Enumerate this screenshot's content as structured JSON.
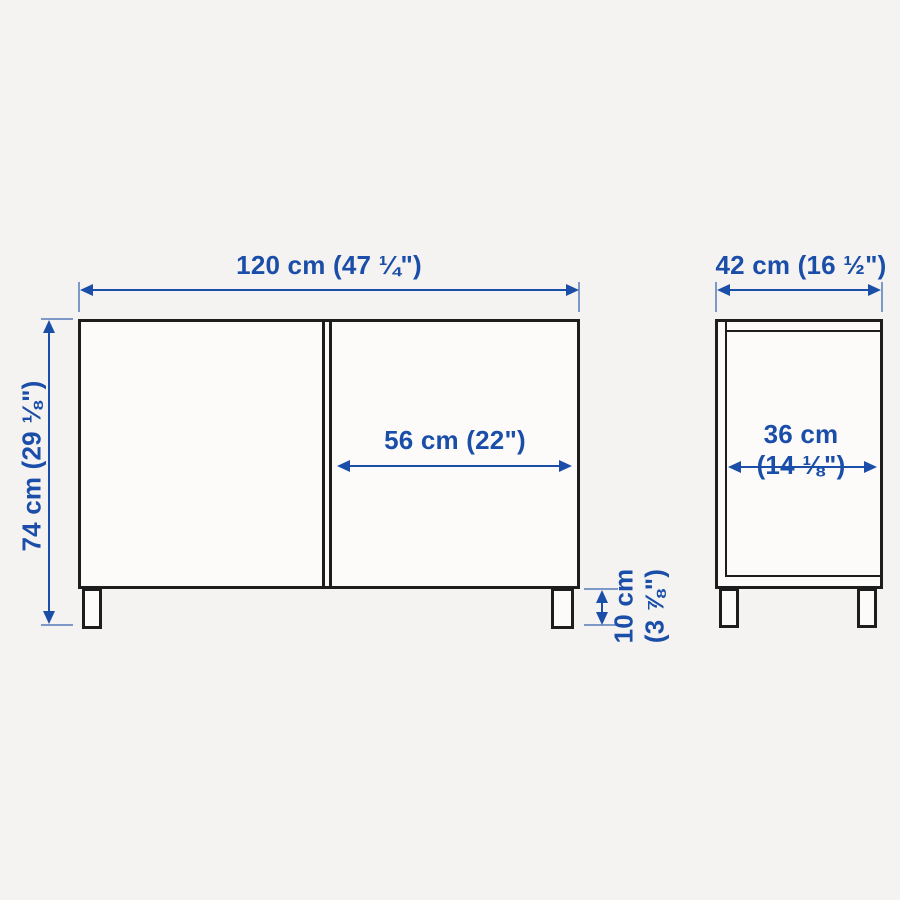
{
  "diagram": {
    "accent_color": "#1a4ea8",
    "outline_color": "#1d1d1d",
    "background_color": "#f5f3f1",
    "front_view": {
      "total_width": {
        "label": "120 cm (47 ¼\")",
        "cm": 120,
        "inches": "47 ¼"
      },
      "total_height": {
        "label": "74 cm (29 ⅛\")",
        "cm": 74,
        "inches": "29 ⅛"
      },
      "door_width": {
        "label": "56 cm (22\")",
        "cm": 56,
        "inches": "22"
      },
      "leg_height": {
        "line1": "10 cm",
        "line2": "(3 ⅞\")",
        "cm": 10,
        "inches": "3 ⅞"
      }
    },
    "side_view": {
      "total_depth": {
        "label": "42 cm (16 ½\")",
        "cm": 42,
        "inches": "16 ½"
      },
      "inner_depth": {
        "line1": "36 cm",
        "line2": "(14 ⅛\")",
        "cm": 36,
        "inches": "14 ⅛"
      }
    }
  }
}
